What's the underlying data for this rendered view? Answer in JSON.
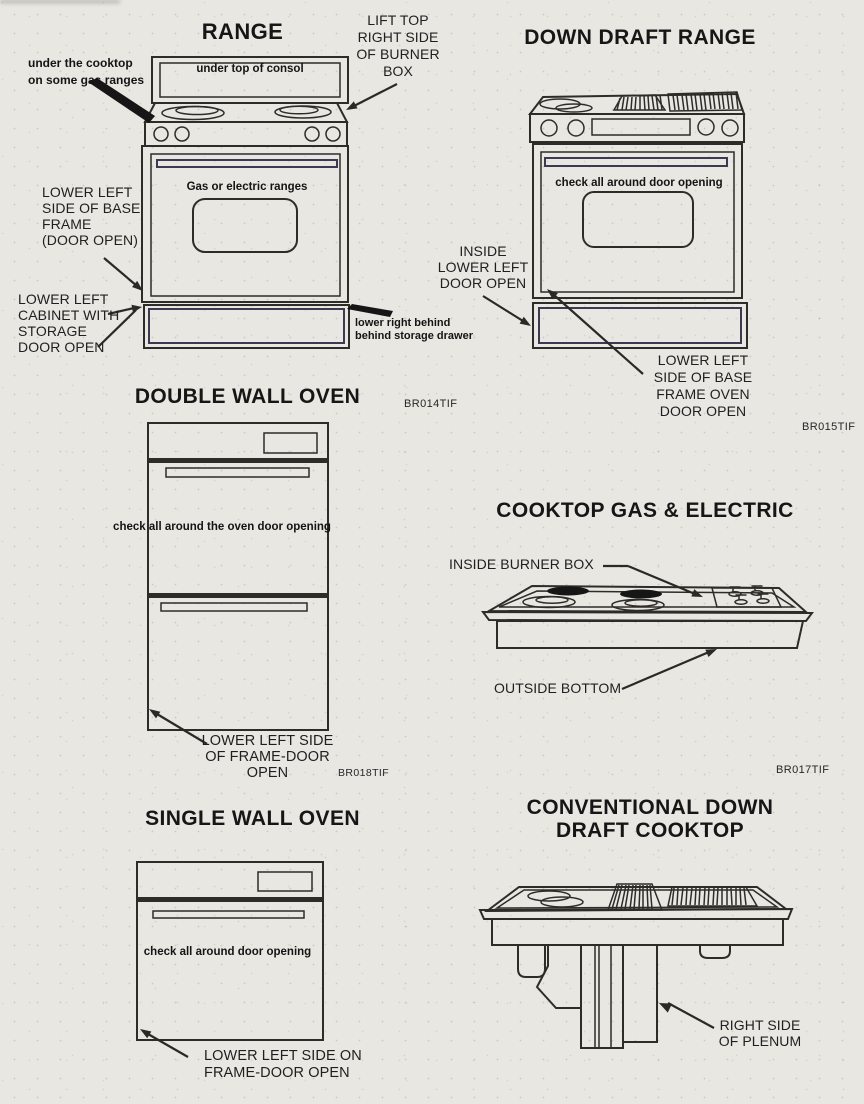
{
  "page": {
    "background": "#e9e7e2",
    "ink": "#2e2c29"
  },
  "figures": {
    "range": {
      "title": "RANGE",
      "console_text": "under top of consol",
      "door_text": "Gas or electric ranges",
      "labels": {
        "under_cooktop": "under the cooktop\non some gas ranges",
        "lift_top": "LIFT TOP\nRIGHT SIDE\nOF BURNER\nBOX",
        "lower_left_base": "LOWER LEFT\nSIDE OF BASE\nFRAME\n(DOOR OPEN)",
        "lower_left_cabinet": "LOWER LEFT\nCABINET WITH\nSTORAGE\nDOOR OPEN",
        "lower_right_behind": "lower right behind\nbehind storage drawer"
      },
      "code": "BR014TIF"
    },
    "down_draft_range": {
      "title": "DOWN DRAFT RANGE",
      "door_text": "check all around door opening",
      "labels": {
        "inside_lower_left": "INSIDE\nLOWER LEFT\nDOOR OPEN",
        "lower_left_base": "LOWER LEFT\nSIDE OF BASE\nFRAME OVEN\nDOOR OPEN"
      },
      "code": "BR015TIF"
    },
    "double_wall_oven": {
      "title": "DOUBLE WALL OVEN",
      "door_text": "check all around the oven door opening",
      "labels": {
        "lower_left": "LOWER LEFT SIDE\nOF FRAME-DOOR\nOPEN"
      },
      "code": "BR018TIF"
    },
    "cooktop_gas_electric": {
      "title": "COOKTOP GAS & ELECTRIC",
      "labels": {
        "inside_burner_box": "INSIDE BURNER BOX",
        "outside_bottom": "OUTSIDE BOTTOM"
      },
      "code": "BR017TIF"
    },
    "single_wall_oven": {
      "title": "SINGLE WALL OVEN",
      "door_text": "check all around door opening",
      "labels": {
        "lower_left": "LOWER LEFT SIDE ON\nFRAME-DOOR OPEN"
      }
    },
    "conventional_down_draft": {
      "title": "CONVENTIONAL DOWN\nDRAFT COOKTOP",
      "labels": {
        "right_side_plenum": "RIGHT SIDE\nOF PLENUM"
      }
    }
  }
}
